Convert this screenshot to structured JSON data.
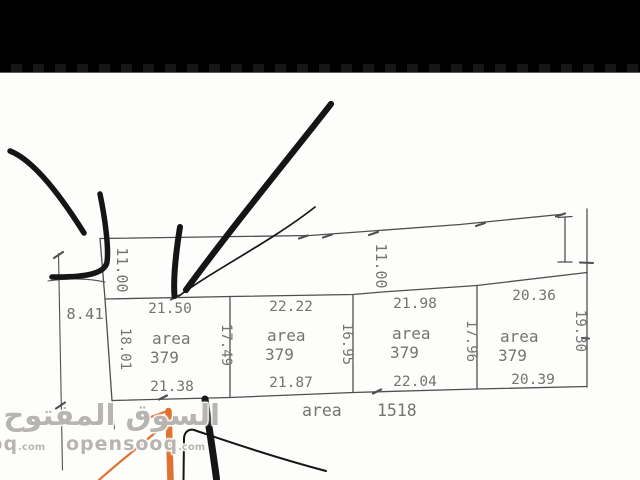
{
  "colors": {
    "topbar": "#000000",
    "paper": "#fdfdfc",
    "plan_line": "#4f4f4f",
    "dim_text": "#767472",
    "marker_ink": "#151515",
    "highlight_orange": "#e0722f",
    "watermark": "#b8b5b1"
  },
  "watermark": {
    "arabic": "السوق المفتوح",
    "latin": "opensooq",
    "tld": ".com"
  },
  "drawing": {
    "road_width_left": "11.00",
    "road_width_mid": "11.00",
    "left_offset": "8.41",
    "total_area_label": "area",
    "total_area_value": "1518",
    "plots": [
      {
        "top": "21.50",
        "bottom": "21.38",
        "left": "18.01",
        "right": "17.49",
        "area_label": "area",
        "area_value": "379"
      },
      {
        "top": "22.22",
        "bottom": "21.87",
        "right": "16.95",
        "area_label": "area",
        "area_value": "379"
      },
      {
        "top": "21.98",
        "bottom": "22.04",
        "right": "17.96",
        "area_label": "area",
        "area_value": "379"
      },
      {
        "top": "20.36",
        "bottom": "20.39",
        "right": "19.30",
        "area_label": "area",
        "area_value": "379"
      }
    ]
  }
}
